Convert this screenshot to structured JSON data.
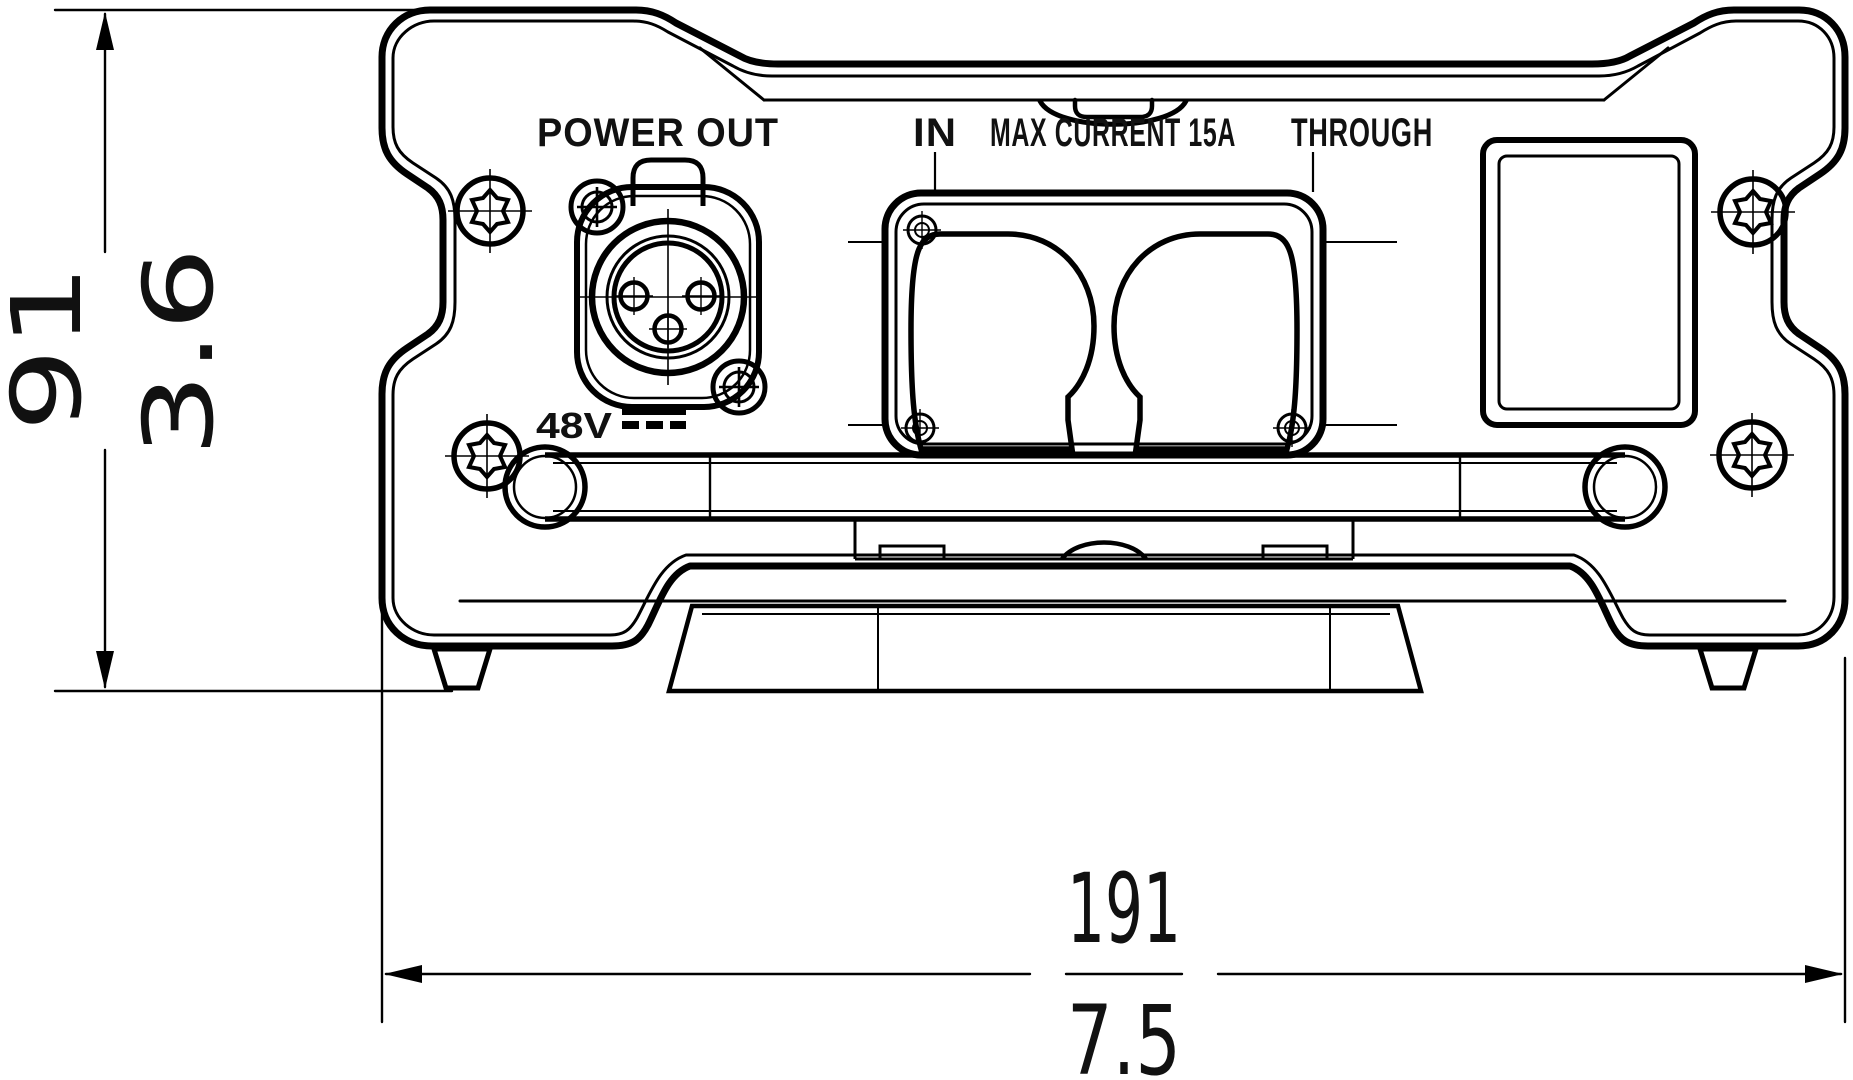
{
  "drawing": {
    "title": "rear panel dimension drawing",
    "panel_labels": {
      "power_out": "POWER OUT",
      "in": "IN",
      "max_current": "MAX CURRENT 15A",
      "through": "THROUGH",
      "voltage": "48V"
    },
    "dimensions": {
      "height_mm": "91",
      "height_in": "3.6",
      "width_mm": "191",
      "width_in": "7.5"
    },
    "colors": {
      "line": "#000000",
      "background": "#ffffff"
    }
  }
}
